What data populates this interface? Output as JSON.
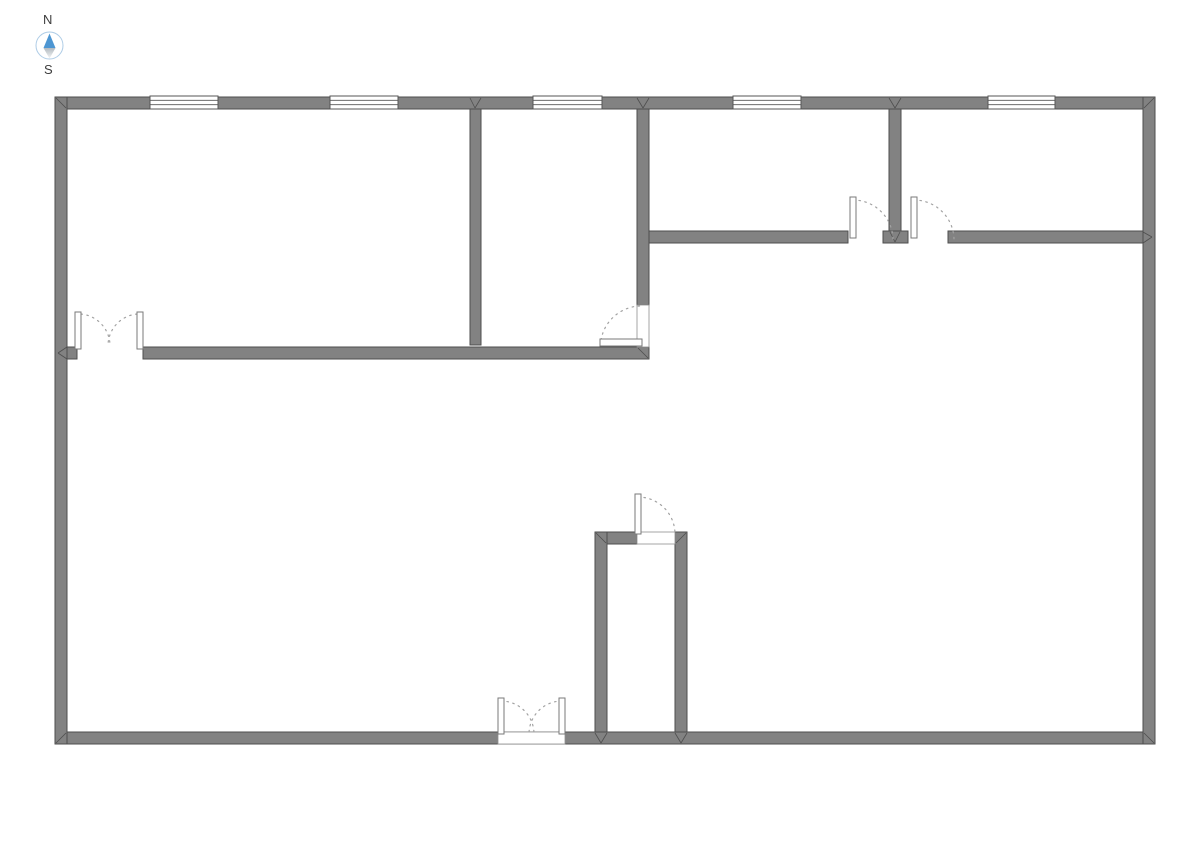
{
  "title": "Floor plan",
  "compass": {
    "north_label": "N",
    "south_label": "S",
    "cx": 49.5,
    "cy": 45.5,
    "r": 13.5
  },
  "colors": {
    "background": "#ffffff",
    "wall_fill": "#828282",
    "wall_stroke": "#4e4e4e",
    "window_fill": "#ffffff",
    "window_stroke": "#555555",
    "opening_fill": "#ffffff",
    "opening_stroke": "#8f8f8f",
    "leaf_fill": "#ffffff",
    "leaf_stroke": "#7a7a7a",
    "arc_stroke": "#a3a3a3",
    "compass_north": "#4d96d2",
    "compass_ring": "#aecce6",
    "compass_text": "#3d3d3d",
    "compass_south_top": "#b3bac0",
    "compass_south_bottom": "#f3f5f6"
  },
  "floorplan": {
    "walls": [
      {
        "x": 55,
        "y": 97,
        "w": 1100,
        "h": 12
      },
      {
        "x": 55,
        "y": 732,
        "w": 1100,
        "h": 12
      },
      {
        "x": 55,
        "y": 97,
        "w": 12,
        "h": 647
      },
      {
        "x": 1143,
        "y": 97,
        "w": 12,
        "h": 647
      },
      {
        "x": 470,
        "y": 109,
        "w": 11,
        "h": 236
      },
      {
        "x": 637,
        "y": 109,
        "w": 12,
        "h": 196
      },
      {
        "x": 889,
        "y": 109,
        "w": 12,
        "h": 134
      },
      {
        "x": 883,
        "y": 231,
        "w": 25,
        "h": 12
      },
      {
        "x": 649,
        "y": 231,
        "w": 199,
        "h": 12
      },
      {
        "x": 948,
        "y": 231,
        "w": 195,
        "h": 12
      },
      {
        "x": 67,
        "y": 347,
        "w": 10,
        "h": 12
      },
      {
        "x": 143,
        "y": 347,
        "w": 506,
        "h": 12
      },
      {
        "x": 595,
        "y": 532,
        "w": 42,
        "h": 12
      },
      {
        "x": 595,
        "y": 532,
        "w": 12,
        "h": 200
      },
      {
        "x": 675,
        "y": 532,
        "w": 12,
        "h": 200
      }
    ],
    "windows": [
      {
        "x": 150,
        "y": 96,
        "w": 68,
        "h": 13
      },
      {
        "x": 330,
        "y": 96,
        "w": 68,
        "h": 13
      },
      {
        "x": 533,
        "y": 96,
        "w": 69,
        "h": 13
      },
      {
        "x": 733,
        "y": 96,
        "w": 68,
        "h": 13
      },
      {
        "x": 988,
        "y": 96,
        "w": 67,
        "h": 13
      }
    ],
    "door_openings": [
      {
        "x": 637,
        "y": 305,
        "w": 12,
        "h": 42
      },
      {
        "x": 637,
        "y": 532,
        "w": 38,
        "h": 12
      },
      {
        "x": 498,
        "y": 732,
        "w": 67,
        "h": 12
      }
    ],
    "door_leaves": [
      {
        "x": 75,
        "y": 312,
        "w": 6,
        "h": 37
      },
      {
        "x": 137,
        "y": 312,
        "w": 6,
        "h": 37
      },
      {
        "x": 850,
        "y": 197,
        "w": 6,
        "h": 41
      },
      {
        "x": 911,
        "y": 197,
        "w": 6,
        "h": 41
      },
      {
        "x": 635,
        "y": 494,
        "w": 6,
        "h": 40
      },
      {
        "x": 498,
        "y": 698,
        "w": 6,
        "h": 36
      },
      {
        "x": 559,
        "y": 698,
        "w": 6,
        "h": 36
      },
      {
        "x": 600,
        "y": 339,
        "w": 42,
        "h": 7
      }
    ],
    "door_arcs": [
      "M 81 314 A 32 32 0 0 1 110 346",
      "M 137 314 A 32 32 0 0 0 108 346",
      "M 853 200 A 40 40 0 0 1 893 240",
      "M 914 200 A 40 40 0 0 1 954 240",
      "M 638 497 A 37 37 0 0 1 675 534",
      "M 501 701 A 33 33 0 0 1 534 734",
      "M 562 701 A 33 33 0 0 0 529 734",
      "M 601 340 A 41 41 0 0 1 640 306"
    ],
    "miter_lines": [
      [
        56,
        98,
        66,
        108
      ],
      [
        1154,
        98,
        1144,
        108
      ],
      [
        56,
        743,
        66,
        733
      ],
      [
        1154,
        743,
        1144,
        733
      ],
      [
        470,
        98,
        475,
        108
      ],
      [
        481,
        98,
        475,
        108
      ],
      [
        637,
        98,
        643,
        108
      ],
      [
        649,
        98,
        643,
        108
      ],
      [
        889,
        98,
        895,
        108
      ],
      [
        901,
        98,
        895,
        108
      ],
      [
        890,
        232,
        895,
        242
      ],
      [
        900,
        232,
        895,
        242
      ],
      [
        638,
        348,
        648,
        358
      ],
      [
        67,
        347,
        58,
        353
      ],
      [
        67,
        359,
        58,
        353
      ],
      [
        1143,
        232,
        1152,
        237
      ],
      [
        1143,
        243,
        1152,
        237
      ],
      [
        596,
        533,
        606,
        543
      ],
      [
        686,
        533,
        676,
        543
      ],
      [
        595,
        733,
        601,
        743
      ],
      [
        607,
        733,
        601,
        743
      ],
      [
        675,
        733,
        681,
        743
      ],
      [
        687,
        733,
        681,
        743
      ]
    ]
  }
}
